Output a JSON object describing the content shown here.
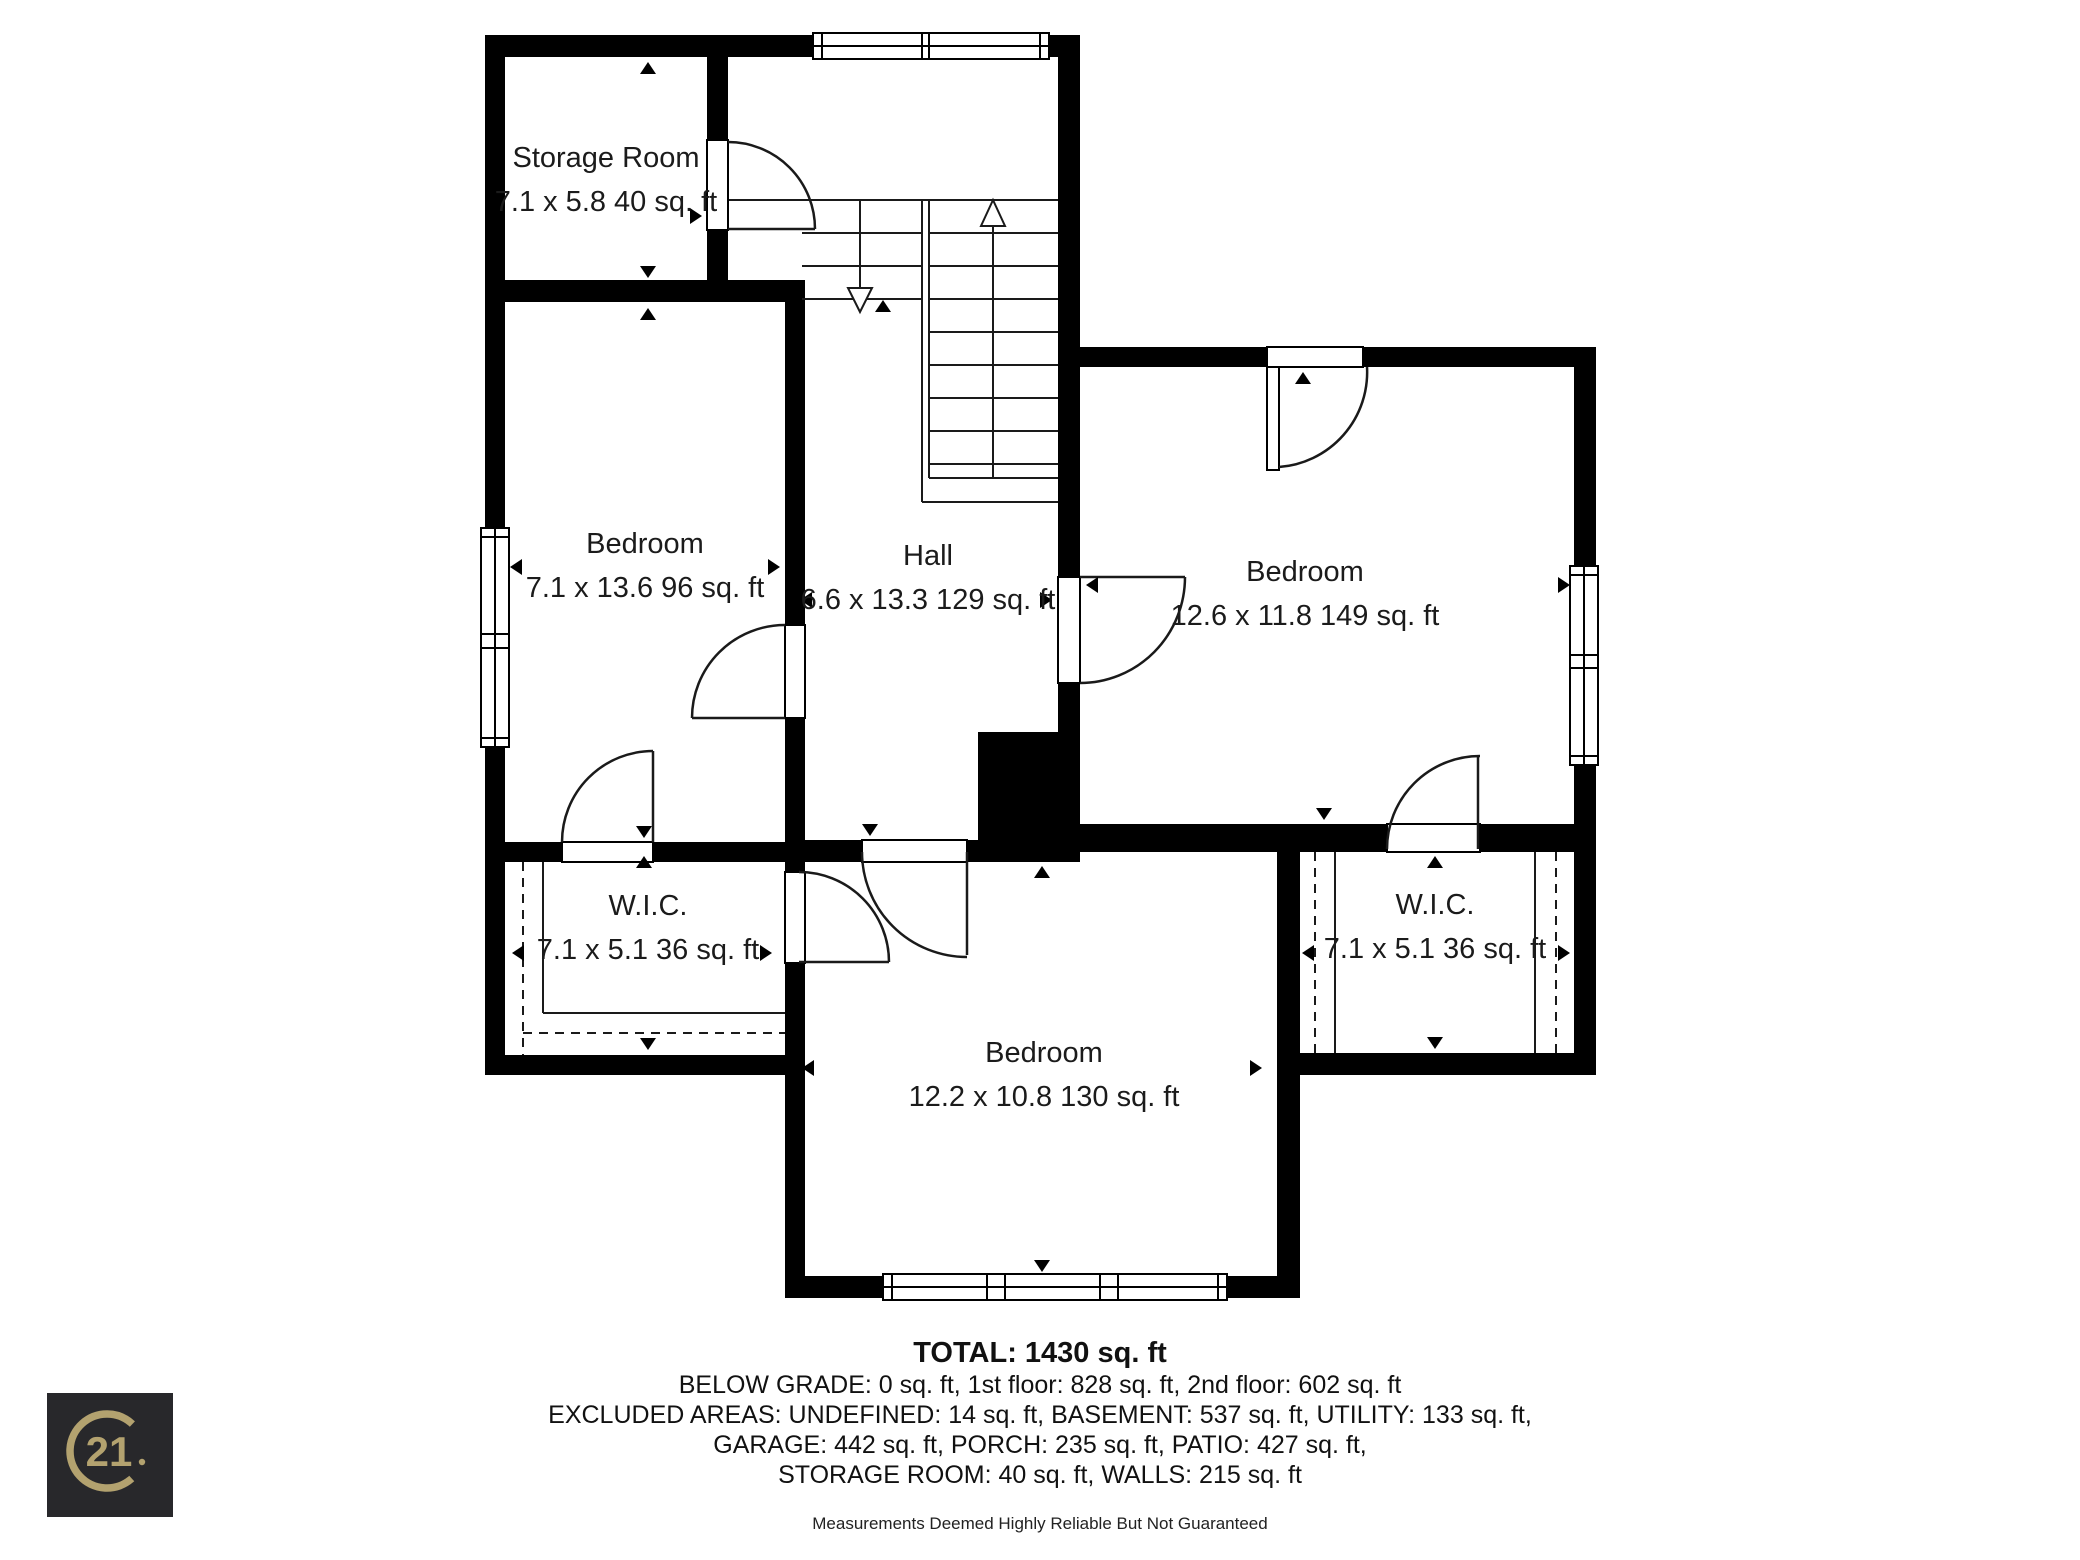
{
  "colors": {
    "wall": "#000000",
    "floor": "#ffffff",
    "text": "#1b1b1b",
    "logo_bg": "#28282b",
    "logo_gold": "#b3a26f"
  },
  "rooms": {
    "storage": {
      "name": "Storage Room",
      "dims": "7.1 x 5.8 40 sq. ft"
    },
    "bedroom_left": {
      "name": "Bedroom",
      "dims": "7.1 x 13.6 96 sq. ft"
    },
    "hall": {
      "name": "Hall",
      "dims": "6.6 x 13.3 129 sq. ft"
    },
    "bedroom_right": {
      "name": "Bedroom",
      "dims": "12.6 x 11.8 149 sq. ft"
    },
    "wic_left": {
      "name": "W.I.C.",
      "dims": "7.1 x 5.1 36 sq. ft"
    },
    "wic_right": {
      "name": "W.I.C.",
      "dims": "7.1 x 5.1 36 sq. ft"
    },
    "bedroom_bottom": {
      "name": "Bedroom",
      "dims": "12.2 x 10.8 130 sq. ft"
    }
  },
  "summary": {
    "total": "TOTAL: 1430 sq. ft",
    "line1": "BELOW GRADE: 0 sq. ft, 1st floor: 828 sq. ft, 2nd floor: 602 sq. ft",
    "line2": "EXCLUDED AREAS: UNDEFINED: 14 sq. ft, BASEMENT: 537 sq. ft, UTILITY: 133 sq. ft,",
    "line3": "GARAGE: 442 sq. ft, PORCH: 235 sq. ft, PATIO: 427 sq. ft,",
    "line4": "STORAGE ROOM: 40 sq. ft, WALLS: 215 sq. ft"
  },
  "disclaimer": "Measurements Deemed Highly Reliable But Not Guaranteed",
  "logo": {
    "text": "21"
  }
}
